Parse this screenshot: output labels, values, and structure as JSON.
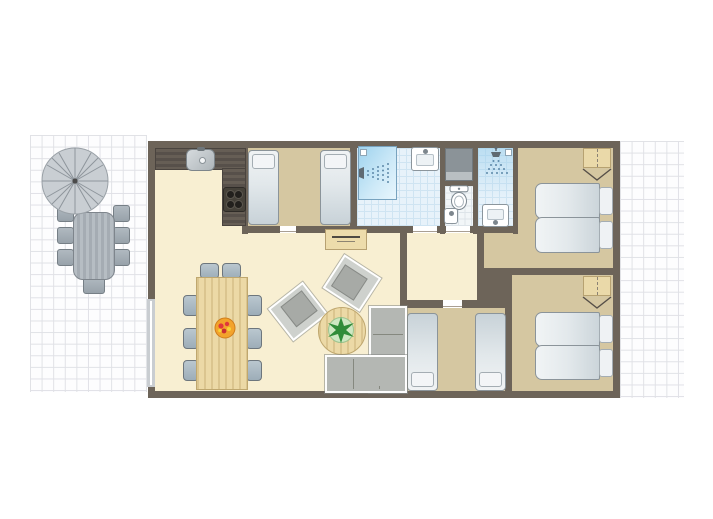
{
  "scene": {
    "kind": "holiday-home-floor-plan",
    "no_visible_text": true,
    "palette": {
      "background": "#ffffff",
      "terrace_tile_line": "#e0e1e6",
      "wall": "#6d6459",
      "floor_living": "#f8efd2",
      "floor_bedroom": "#d5c7a1",
      "floor_bathroom": "#e7f2fa",
      "shower_blue": "#9fd3ee",
      "kitchen_counter": "#57504a",
      "wood_furniture": "#ecd9a6",
      "grey_furniture": "#b4b7b3",
      "bed_linen": "#e2e8eb",
      "plant_green": "#2f8c39",
      "fruit_orange": "#f3a32b"
    }
  },
  "outdoor": {
    "left_terrace": {
      "floor": "white-tiles",
      "furniture": [
        "parasol",
        "garden-table",
        "garden-chair x7"
      ]
    },
    "right_terrace": {
      "floor": "white-tiles",
      "furniture": []
    }
  },
  "rooms": [
    {
      "id": "living-kitchen",
      "floor": "cream",
      "furniture": [
        "kitchen-counter-L",
        "kitchen-sink",
        "cooktop-4-burners",
        "dining-table",
        "dining-chair x8",
        "fruit-bowl",
        "sideboard",
        "armchair x2",
        "round-coffee-table",
        "plant",
        "corner-sofa"
      ]
    },
    {
      "id": "bedroom-top-middle",
      "floor": "khaki",
      "furniture": [
        "single-bed x2"
      ]
    },
    {
      "id": "bathroom",
      "floor": "blue-tile",
      "furniture": [
        "shower",
        "washbasin"
      ]
    },
    {
      "id": "utility-closet",
      "floor": "none",
      "furniture": [
        "cabinet"
      ]
    },
    {
      "id": "wc",
      "floor": "white-tile",
      "furniture": [
        "toilet",
        "hand-basin"
      ]
    },
    {
      "id": "shower-room",
      "floor": "blue-tile",
      "furniture": [
        "overhead-shower",
        "washbasin"
      ]
    },
    {
      "id": "hallway",
      "floor": "cream",
      "furniture": []
    },
    {
      "id": "bedroom-right-top",
      "floor": "khaki",
      "furniture": [
        "double-bed",
        "wardrobe"
      ]
    },
    {
      "id": "bedroom-right-bottom",
      "floor": "khaki",
      "furniture": [
        "double-bed",
        "wardrobe"
      ]
    },
    {
      "id": "bedroom-bottom-middle",
      "floor": "khaki",
      "furniture": [
        "single-bed x2"
      ]
    }
  ],
  "openings": {
    "left_wall_window": true,
    "interior_door_gaps": [
      "bedroom-top-middle",
      "bathroom",
      "wc",
      "bedroom-bottom-middle"
    ]
  }
}
